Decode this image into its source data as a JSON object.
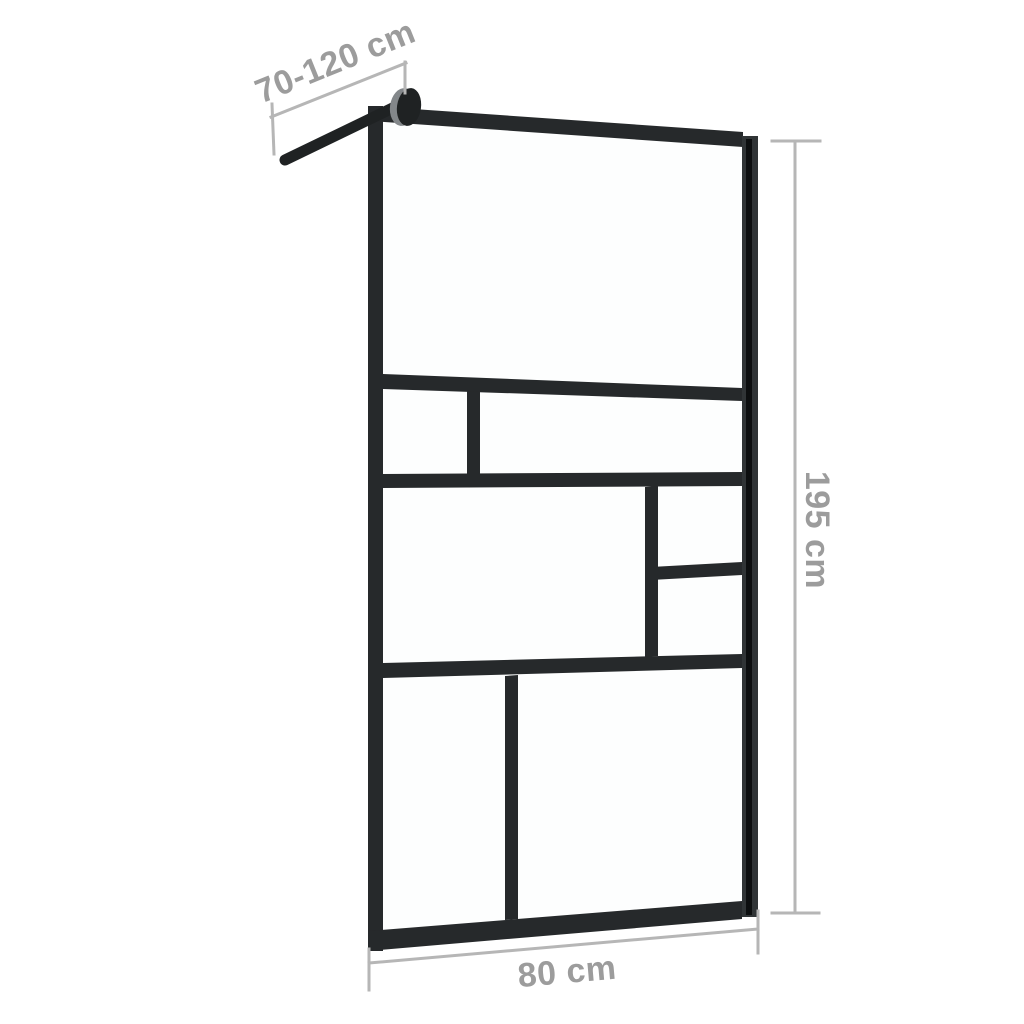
{
  "page": {
    "background": "#ffffff",
    "kind": "product-dimension-diagram"
  },
  "colors": {
    "background": "#ffffff",
    "glass": "#fdfefe",
    "frame": "#26292b",
    "frame_light": "#303436",
    "frame_stripe": "#0c0e0f",
    "knob": "#1f2223",
    "knob_highlight": "#83878a",
    "dim_line": "#b6b6b6",
    "dim_text": "#9c9c9c"
  },
  "diagram": {
    "dimensions": {
      "support_bar": {
        "label": "70-120 cm"
      },
      "height": {
        "label": "195 cm"
      },
      "width": {
        "label": "80 cm"
      }
    }
  }
}
